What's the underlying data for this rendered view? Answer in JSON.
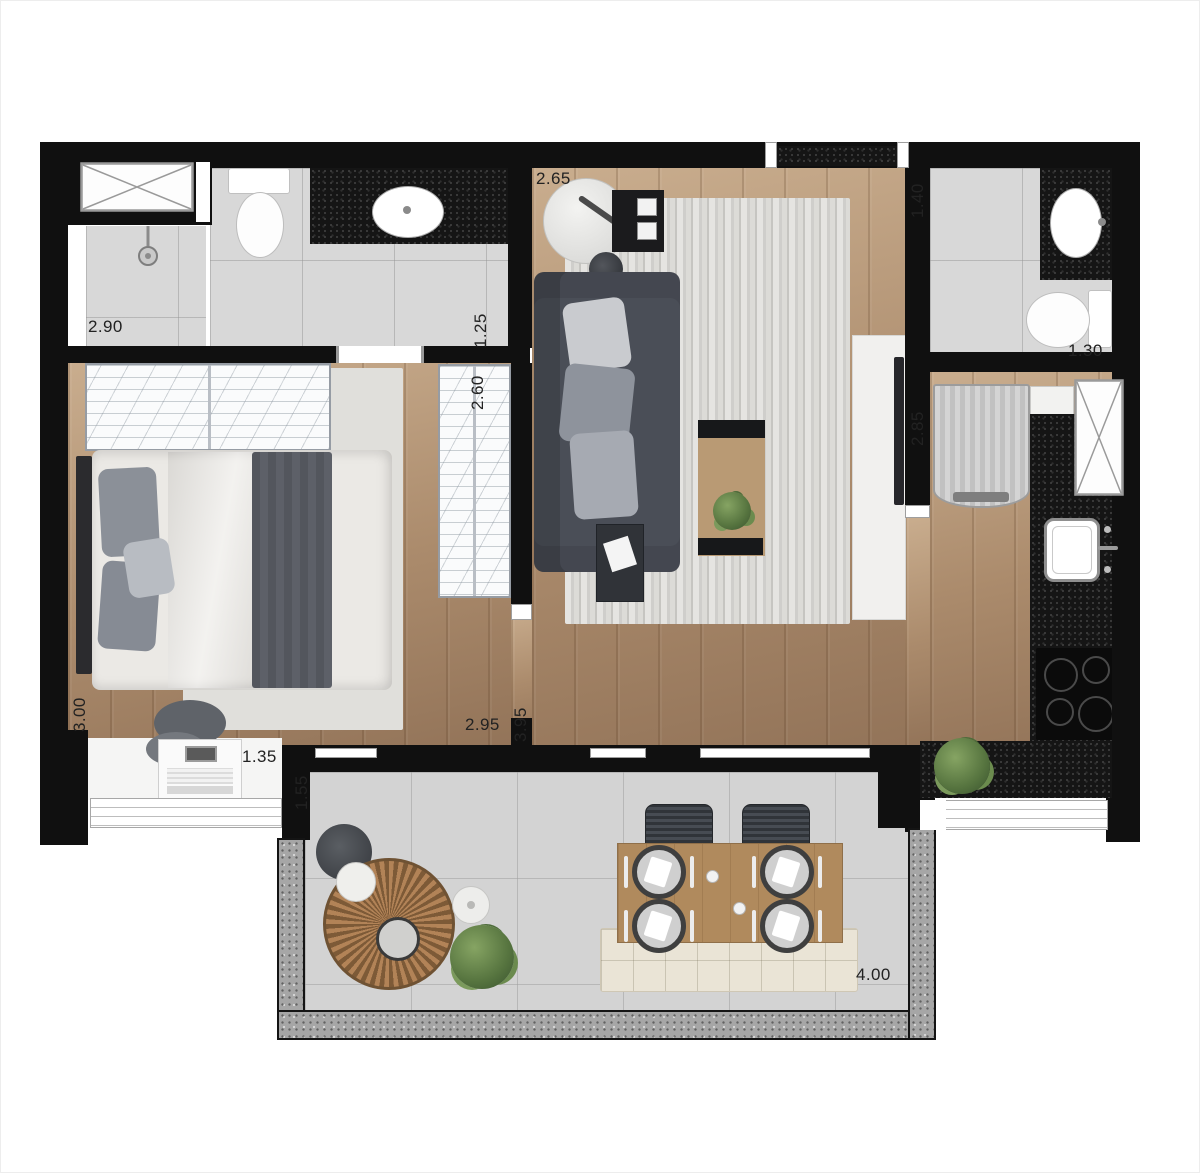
{
  "dimension_labels": {
    "bath1_width": "2.90",
    "bath1_depth": "1.25",
    "living_width": "2.65",
    "bath2_depth": "1.40",
    "bath2_width": "1.30",
    "wardrobe_length": "2.60",
    "kitchen_depth": "2.85",
    "bedroom_depth": "3.00",
    "bedroom_width": "2.95",
    "living_depth": "3.95",
    "laundry_width": "1.35",
    "balcony_depth": "1.55",
    "balcony_width": "4.00"
  },
  "colors": {
    "wall": "#101010",
    "wood_floor": "#ab8b6c",
    "tile_floor": "#d8d8d8",
    "balcony_floor": "#d3d3d3",
    "dark_counter": "#151515",
    "granite_wall": "#a6a6a6",
    "sofa": "#4a4e57",
    "plant": "#56743f",
    "dining_table_wood": "#b08a5d"
  }
}
